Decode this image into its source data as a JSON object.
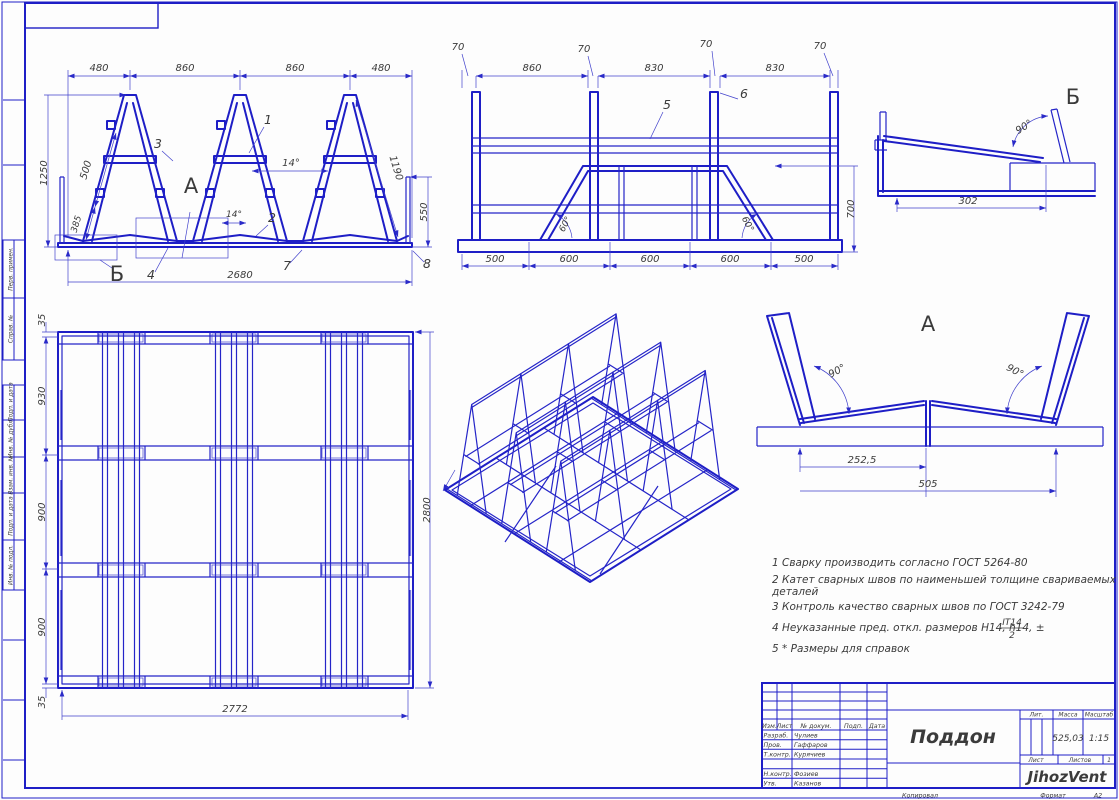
{
  "sheet": {
    "copied": "Копировал",
    "format_label": "Формат",
    "format_value": "А2"
  },
  "margin": {
    "labels": [
      "Перв. примен.",
      "Справ. №",
      "Подп. и дата",
      "Инв. № дубл.",
      "Взам. инв. №",
      "Подп. и дата",
      "Инв. № подл."
    ]
  },
  "front_view": {
    "top_dims": [
      "480",
      "860",
      "860",
      "480"
    ],
    "bottom_dim": "2680",
    "height_dim": "1250",
    "diag_dim_upper": "500",
    "diag_dim_lower": "385",
    "right_height_dim": "550",
    "right_diag_dim": "1190",
    "angle_1": "14°",
    "angle_2": "14°",
    "label_1": "1",
    "label_2": "2",
    "label_3": "3",
    "label_4": "4",
    "label_7": "7",
    "label_8": "8",
    "zone_a": "А",
    "zone_b": "Б"
  },
  "side_view": {
    "width_dims": [
      "70",
      "70",
      "70",
      "70"
    ],
    "span_dims": [
      "860",
      "830",
      "830"
    ],
    "bottom_dims": [
      "500",
      "600",
      "600",
      "600",
      "500"
    ],
    "height_dim": "700",
    "angle_1": "60°",
    "angle_2": "60°",
    "label_5": "5",
    "label_6": "6"
  },
  "detail_b": {
    "title": "Б",
    "dim": "302",
    "angle": "90°"
  },
  "plan_view": {
    "side_dims": [
      "35",
      "930",
      "900",
      "900",
      "35"
    ],
    "bottom_dim": "2772",
    "right_dim": "2800"
  },
  "detail_a": {
    "title": "А",
    "dim_half": "252,5",
    "dim_full": "505",
    "angle_left": "90°",
    "angle_right": "90°"
  },
  "notes": {
    "line1": "1 Сварку производить согласно ГОСТ 5264-80",
    "line2a": "2 Катет  сварных  швов  по  наименьшей  толщине  свариваемых",
    "line2b": "деталей",
    "line3": "3 Контроль качество сварных швов по ГОСТ 3242-79",
    "line4": "4  Неуказанные пред. откл. размеров Н14, h14, ±",
    "frac_top": "IT14",
    "frac_bottom": "2",
    "line5": "5  * Размеры для справок"
  },
  "title_block": {
    "title": "Поддон",
    "col_izm": "Изм.",
    "col_list": "Лист",
    "col_ndoc": "№ докум.",
    "col_podp": "Подп.",
    "col_data": "Дата",
    "r1_label": "Разраб.",
    "r1_name": "Чулиев",
    "r2_label": "Пров.",
    "r2_name": "Гаффаров",
    "r3_label": "Т.контр.",
    "r3_name": "Курячиев",
    "r4_label": "Н.контр.",
    "r4_name": "Фозиев",
    "r5_label": "Утв.",
    "r5_name": "Казанов",
    "lit": "Лит.",
    "mass": "Масса",
    "scale": "Масштаб",
    "mass_value": "525,03",
    "scale_value": "1:15",
    "sheet": "Лист",
    "sheets": "Листов",
    "sheets_value": "1",
    "company": "JihozVent"
  }
}
